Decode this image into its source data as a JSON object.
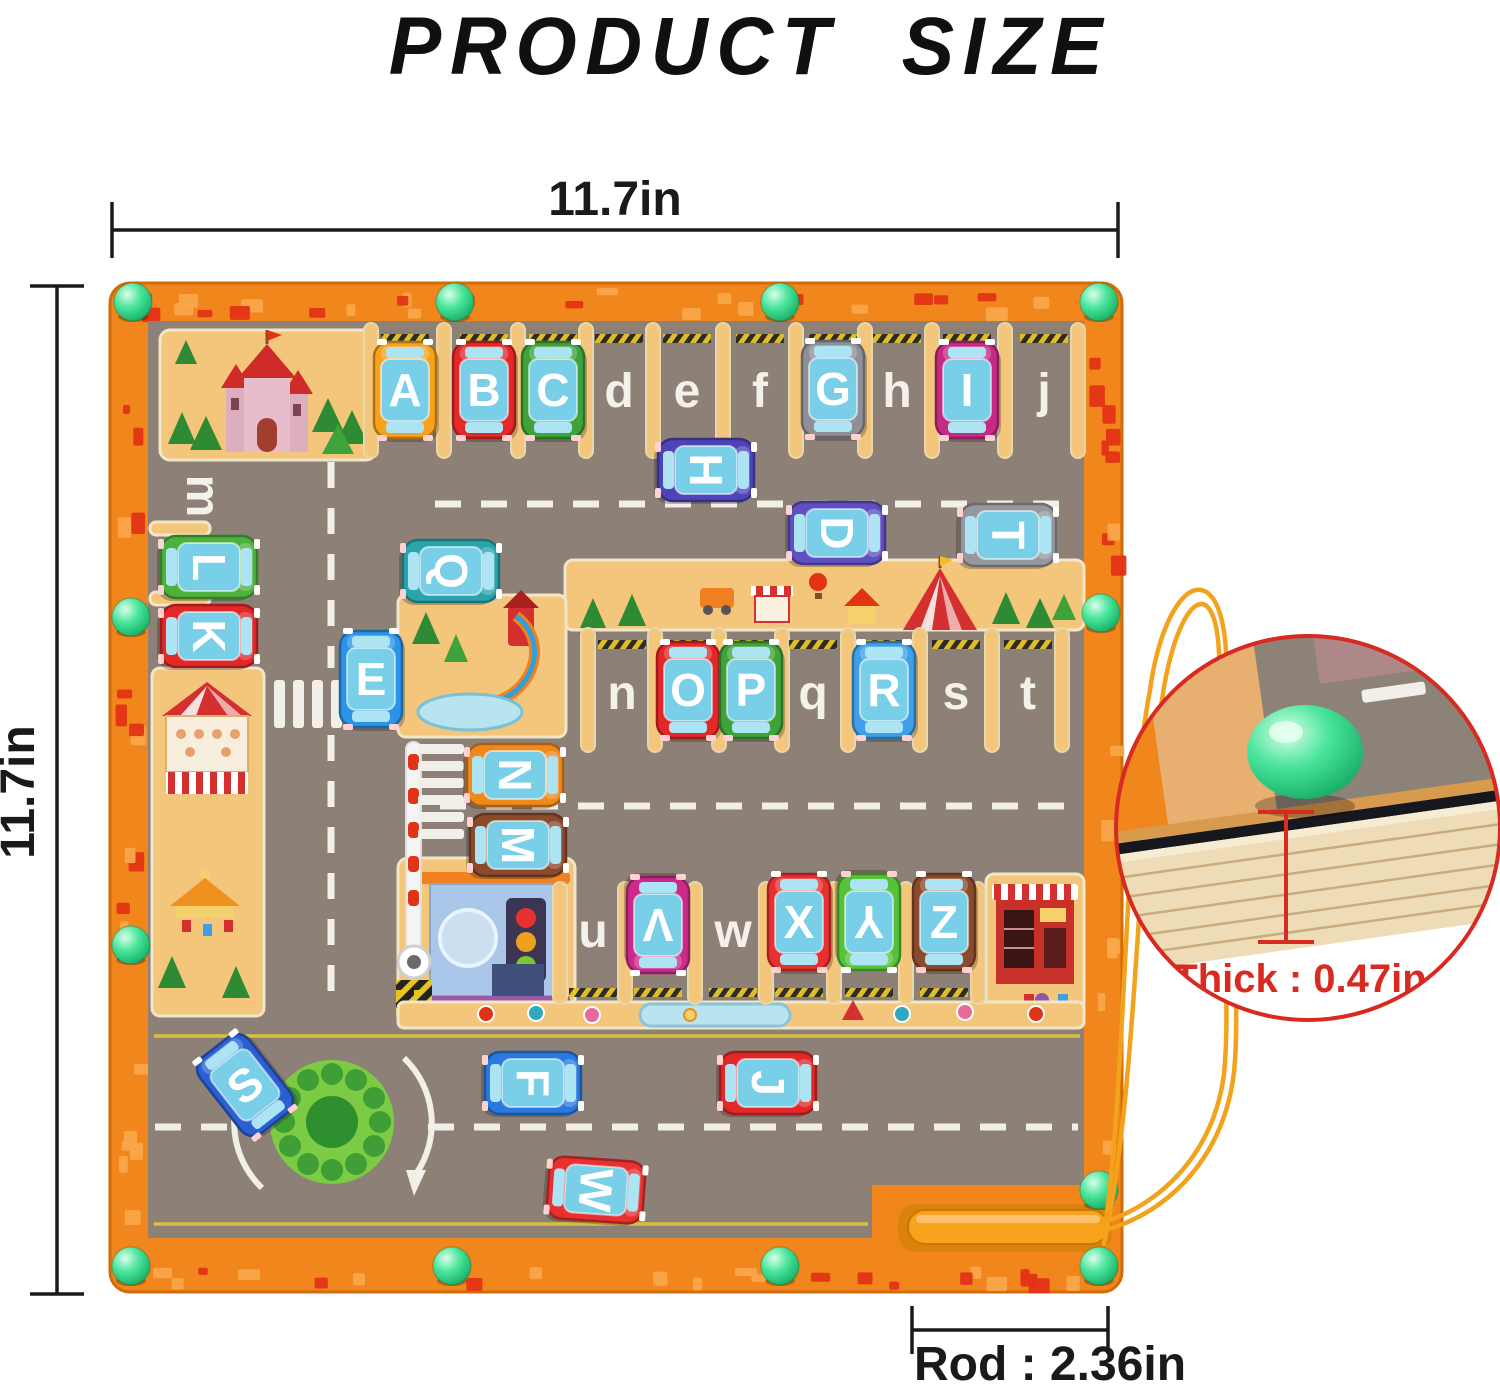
{
  "title": "PRODUCT SIZE",
  "dimensions": {
    "width": "11.7in",
    "height": "11.7in",
    "rod": "Rod : 2.36in",
    "thickness": "Thick : 0.47in"
  },
  "board": {
    "cars": [
      {
        "letter": "A",
        "color": "#f6a21c",
        "x": 405,
        "y": 390,
        "rot": 0
      },
      {
        "letter": "B",
        "color": "#e22828",
        "x": 484,
        "y": 390,
        "rot": 0
      },
      {
        "letter": "C",
        "color": "#3fa23a",
        "x": 553,
        "y": 390,
        "rot": 0
      },
      {
        "letter": "G",
        "color": "#8f8f97",
        "x": 833,
        "y": 389,
        "rot": 0
      },
      {
        "letter": "I",
        "color": "#c62a85",
        "x": 967,
        "y": 390,
        "rot": 0
      },
      {
        "letter": "H",
        "color": "#4f43b8",
        "x": 706,
        "y": 470,
        "rot": 90
      },
      {
        "letter": "D",
        "color": "#5f4fc2",
        "x": 837,
        "y": 533,
        "rot": 90
      },
      {
        "letter": "T",
        "color": "#97979e",
        "x": 1008,
        "y": 535,
        "rot": 90
      },
      {
        "letter": "Q",
        "color": "#2aa4ab",
        "x": 451,
        "y": 571,
        "rot": 90
      },
      {
        "letter": "L",
        "color": "#4cb23c",
        "x": 209,
        "y": 567,
        "rot": 90
      },
      {
        "letter": "K",
        "color": "#e22828",
        "x": 209,
        "y": 636,
        "rot": 90
      },
      {
        "letter": "E",
        "color": "#2b93e8",
        "x": 371,
        "y": 679,
        "rot": 0
      },
      {
        "letter": "O",
        "color": "#e22828",
        "x": 688,
        "y": 690,
        "rot": 0
      },
      {
        "letter": "P",
        "color": "#3fa23a",
        "x": 751,
        "y": 690,
        "rot": 0
      },
      {
        "letter": "R",
        "color": "#3e9fe8",
        "x": 884,
        "y": 690,
        "rot": 0
      },
      {
        "letter": "N",
        "color": "#f0891c",
        "x": 515,
        "y": 775,
        "rot": 90
      },
      {
        "letter": "M",
        "color": "#8a4a2b",
        "x": 518,
        "y": 845,
        "rot": 90
      },
      {
        "letter": "V",
        "color": "#cc2a8a",
        "x": 658,
        "y": 925,
        "rot": 180
      },
      {
        "letter": "X",
        "color": "#e83030",
        "x": 799,
        "y": 922,
        "rot": 0
      },
      {
        "letter": "Y",
        "color": "#55c23a",
        "x": 869,
        "y": 922,
        "rot": 180
      },
      {
        "letter": "Z",
        "color": "#8a4a2b",
        "x": 944,
        "y": 922,
        "rot": 0
      },
      {
        "letter": "S",
        "color": "#2b5fd4",
        "x": 245,
        "y": 1085,
        "rot": -38
      },
      {
        "letter": "F",
        "color": "#2979e0",
        "x": 533,
        "y": 1083,
        "rot": 90
      },
      {
        "letter": "J",
        "color": "#e22828",
        "x": 768,
        "y": 1083,
        "rot": 90
      },
      {
        "letter": "W",
        "color": "#e83030",
        "x": 596,
        "y": 1190,
        "rot": 94
      }
    ],
    "empty_slots": [
      {
        "letter": "d",
        "x": 619,
        "y": 390,
        "rot": 0
      },
      {
        "letter": "e",
        "x": 687,
        "y": 390,
        "rot": 0
      },
      {
        "letter": "f",
        "x": 760,
        "y": 390,
        "rot": 0
      },
      {
        "letter": "h",
        "x": 897,
        "y": 390,
        "rot": 0
      },
      {
        "letter": "j",
        "x": 1044,
        "y": 390,
        "rot": 0
      },
      {
        "letter": "m",
        "x": 204,
        "y": 496,
        "rot": 90
      },
      {
        "letter": "n",
        "x": 622,
        "y": 692,
        "rot": 0
      },
      {
        "letter": "q",
        "x": 813,
        "y": 692,
        "rot": 0
      },
      {
        "letter": "s",
        "x": 956,
        "y": 692,
        "rot": 0
      },
      {
        "letter": "t",
        "x": 1028,
        "y": 692,
        "rot": 0
      },
      {
        "letter": "u",
        "x": 593,
        "y": 930,
        "rot": 0
      },
      {
        "letter": "w",
        "x": 733,
        "y": 930,
        "rot": 0
      }
    ],
    "balls": [
      {
        "x": 133,
        "y": 302
      },
      {
        "x": 455,
        "y": 302
      },
      {
        "x": 780,
        "y": 302
      },
      {
        "x": 1099,
        "y": 302
      },
      {
        "x": 131,
        "y": 617
      },
      {
        "x": 131,
        "y": 945
      },
      {
        "x": 1101,
        "y": 613
      },
      {
        "x": 131,
        "y": 1266
      },
      {
        "x": 452,
        "y": 1266
      },
      {
        "x": 780,
        "y": 1266
      },
      {
        "x": 1099,
        "y": 1266
      },
      {
        "x": 1099,
        "y": 1190
      }
    ]
  },
  "colors": {
    "frame_orange": "#f0861c",
    "road_gray": "#8d8177",
    "wood_tan": "#f3c67c",
    "ball_green": "#3fe08f",
    "inset_red": "#d82a20",
    "string_orange": "#f2a21b",
    "dimension_black": "#1a1a1a",
    "car_window_blue": "#79cfe8",
    "letter_white": "#f4f1ea"
  }
}
